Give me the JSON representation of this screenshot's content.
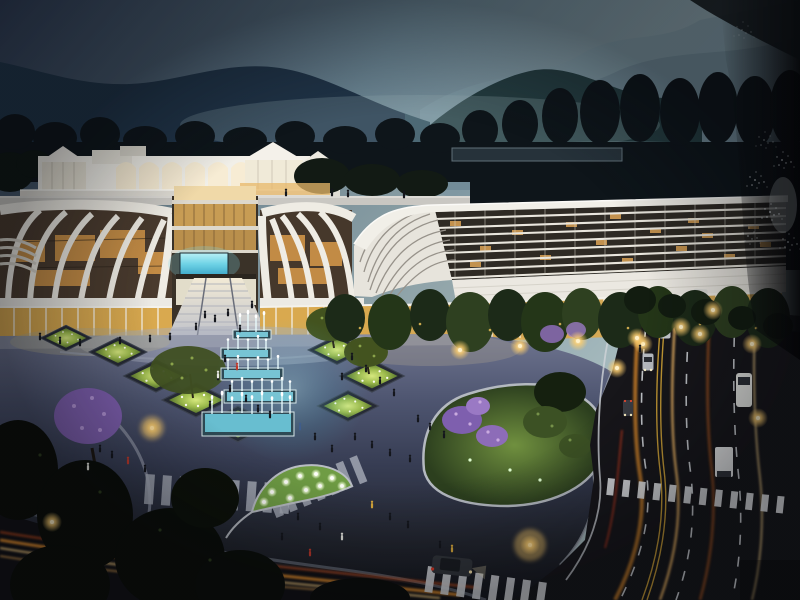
{
  "meta": {
    "title": "Night-time architectural rendering photo",
    "media": "photograph of a glossy printed rendering board",
    "subject": "curved white commercial complex at dusk with illuminated plaza, cascading fountain, planted diamonds, tree-lined roads with traffic light-trails, misty mountain backdrop",
    "visible_text": "none"
  },
  "palette": {
    "sky_top": "#2c3950",
    "sky_mid": "#6a8492",
    "sky_horizon": "#a9bdc0",
    "mountain_far": "#7d97a2",
    "mountain_mid": "#33505f",
    "mountain_left": "#203448",
    "hill_forest": "#243c40",
    "treeline": "#0e151a",
    "building_white": "#f1efe8",
    "arch_glow": "#f7ecd4",
    "glass_warm": "#d9a94f",
    "window_amber": "#dca456",
    "louver_bg": "#2e2a24",
    "screen_cyan": "#6fd3e6",
    "fountain_cyan": "#4fc4dc",
    "jet_white": "#eafdff",
    "plaza_top": "#6f7590",
    "plaza_deep": "#15161c",
    "shrub_lit": "#9cba4c",
    "blossom_purple": "#7e5fae",
    "lawn_green": "#70903f",
    "road_dark": "#17161a",
    "marking_white": "#d8dce0",
    "marking_yellow": "#d8a837",
    "trail_orange": "#ff9d2f",
    "trail_amber": "#ffd485",
    "trail_red": "#c84b20",
    "lamp_core": "#fff1c8",
    "people_dark": "#14161c",
    "glare_black": "#050506"
  },
  "scene": {
    "sky": "overcast dusk sky, darker at upper left",
    "mountains": "layered misty ridges, forested hill at right",
    "buildings": [
      "arched rooftop pavilion with gabled glass roofs",
      "left curved-ribbon facade wing",
      "central glass atrium with cyan LED screen and grand staircase",
      "right curved-ribbon facade wing",
      "long louvered wing with white swoosh roof band"
    ],
    "plaza": [
      "cascading cyan-lit fountain terraces",
      "diamond planters with uplit shrubs",
      "leaf-shaped planter with glowing orbs",
      "striped pedestrian walkways",
      "garden island with purple blossoms",
      "scattered pedestrians"
    ],
    "roads": [
      "curved multi-lane road with dashed markings and zebra crossings",
      "cars, trucks and bus with headlight trails",
      "warm street lamps",
      "orange long-exposure light trails"
    ],
    "artifact": "specular glare streak of the glossy print along the right edge"
  }
}
